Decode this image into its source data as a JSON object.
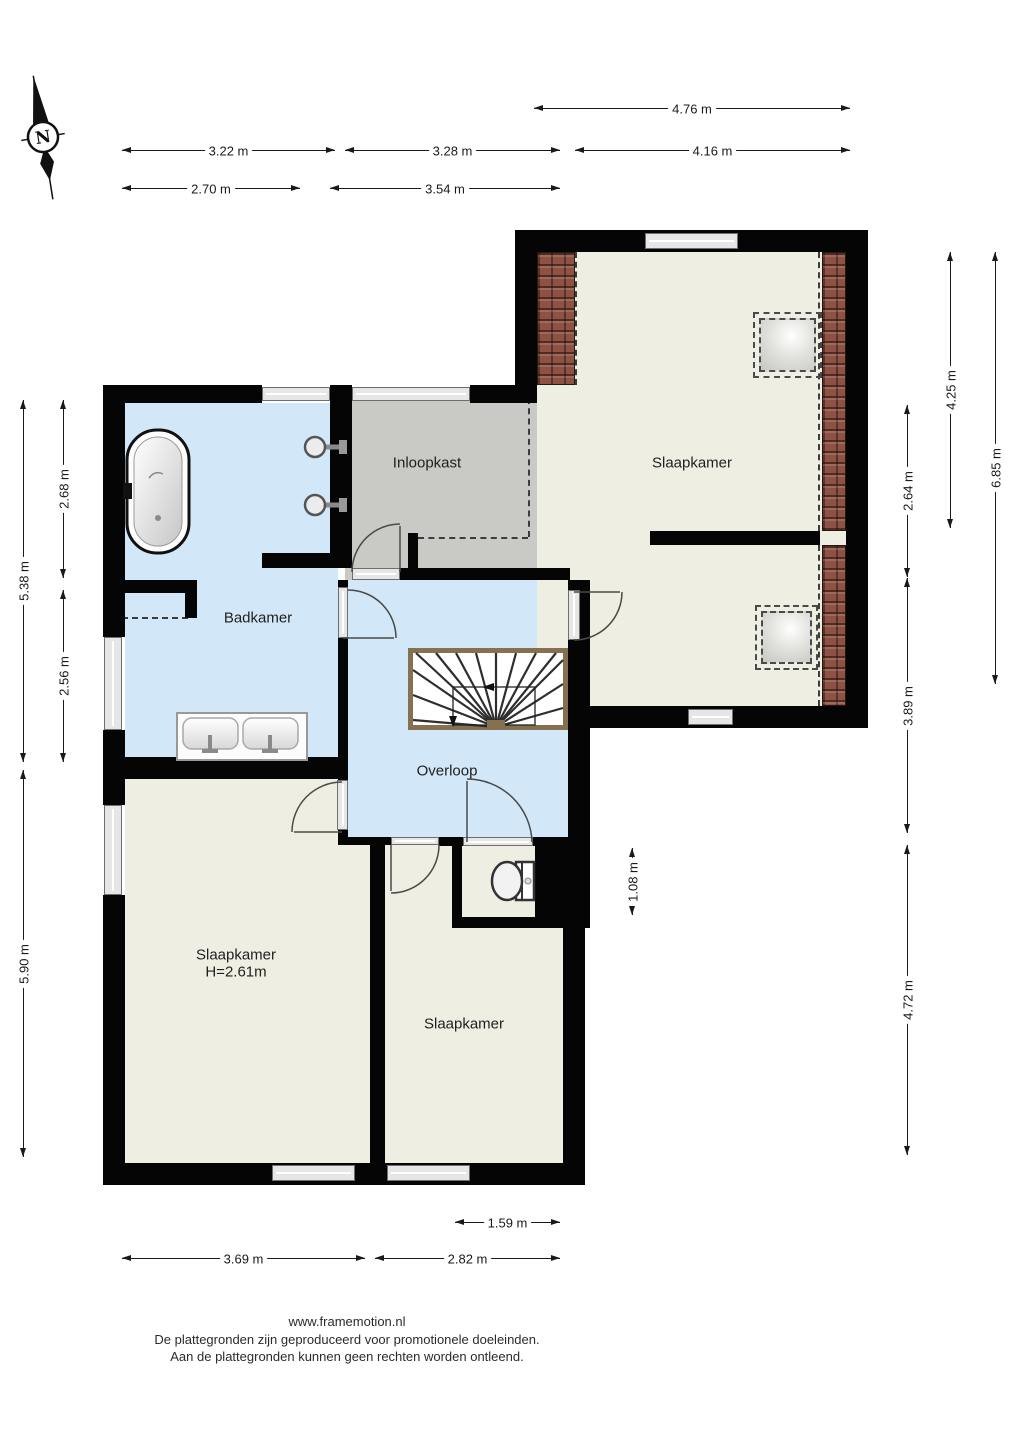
{
  "compass": {
    "label": "N"
  },
  "rooms": {
    "inloopkast": "Inloopkast",
    "slaapkamer_tr": "Slaapkamer",
    "badkamer": "Badkamer",
    "overloop": "Overloop",
    "slaapkamer_bl": "Slaapkamer",
    "slaapkamer_bl_height": "H=2.61m",
    "slaapkamer_br": "Slaapkamer"
  },
  "dims": [
    {
      "label": "4.76 m"
    },
    {
      "label": "3.22 m"
    },
    {
      "label": "3.28 m"
    },
    {
      "label": "4.16 m"
    },
    {
      "label": "2.70 m"
    },
    {
      "label": "3.54 m"
    },
    {
      "label": "5.38 m"
    },
    {
      "label": "2.68 m"
    },
    {
      "label": "2.56 m"
    },
    {
      "label": "5.90 m"
    },
    {
      "label": "4.25 m"
    },
    {
      "label": "6.85 m"
    },
    {
      "label": "2.64 m"
    },
    {
      "label": "3.89 m"
    },
    {
      "label": "1.08 m"
    },
    {
      "label": "4.72 m"
    },
    {
      "label": "1.59 m"
    },
    {
      "label": "3.69 m"
    },
    {
      "label": "2.82 m"
    }
  ],
  "footer": {
    "site": "www.framemotion.nl",
    "line2": "De plattegronden zijn geproduceerd voor promotionele doeleinden.",
    "line3": "Aan de plattegronden kunnen geen rechten worden ontleend."
  },
  "colors": {
    "floor_blue": "#d2e7f7",
    "floor_cream": "#eeeee3",
    "floor_gray": "#c9c9c5",
    "wall": "#050505",
    "roof_tile": "#8d5244",
    "stair_trim": "#857050"
  }
}
